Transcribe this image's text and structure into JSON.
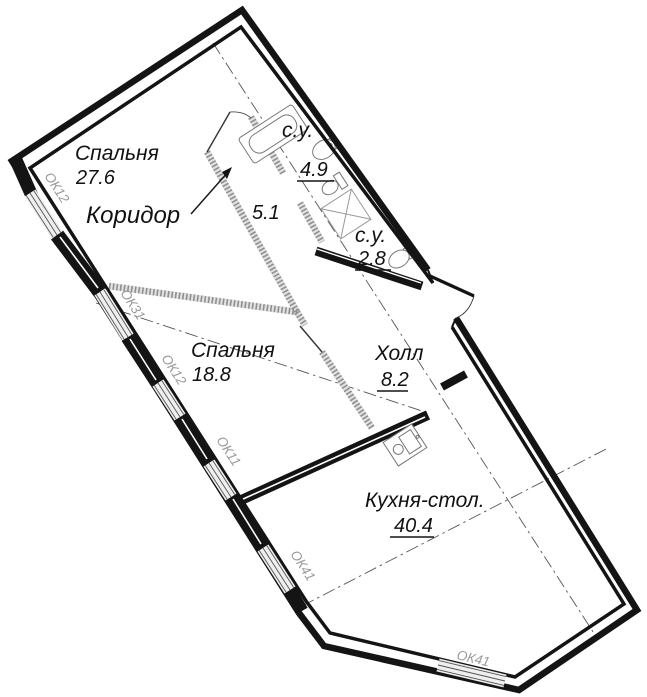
{
  "plan": {
    "rooms": [
      {
        "name": "Спальня",
        "area": "27.6"
      },
      {
        "name": "с.у.",
        "area": "4.9"
      },
      {
        "name": "Коридор",
        "area": "5.1"
      },
      {
        "name": "с.у.",
        "area": "2.8"
      },
      {
        "name": "Спальня",
        "area": "18.8"
      },
      {
        "name": "Холл",
        "area": "8.2"
      },
      {
        "name": "Кухня-стол.",
        "area": "40.4"
      }
    ],
    "windows": [
      {
        "label": "ОК12"
      },
      {
        "label": "ОК31"
      },
      {
        "label": "ОК12"
      },
      {
        "label": "ОК11"
      },
      {
        "label": "ОК41"
      },
      {
        "label": "ОК41"
      }
    ],
    "colors": {
      "wall": "#141414",
      "partition": "#b3b3b3",
      "window_band": "#efefef",
      "label_gray": "#9a9a9a",
      "background": "#ffffff"
    }
  }
}
